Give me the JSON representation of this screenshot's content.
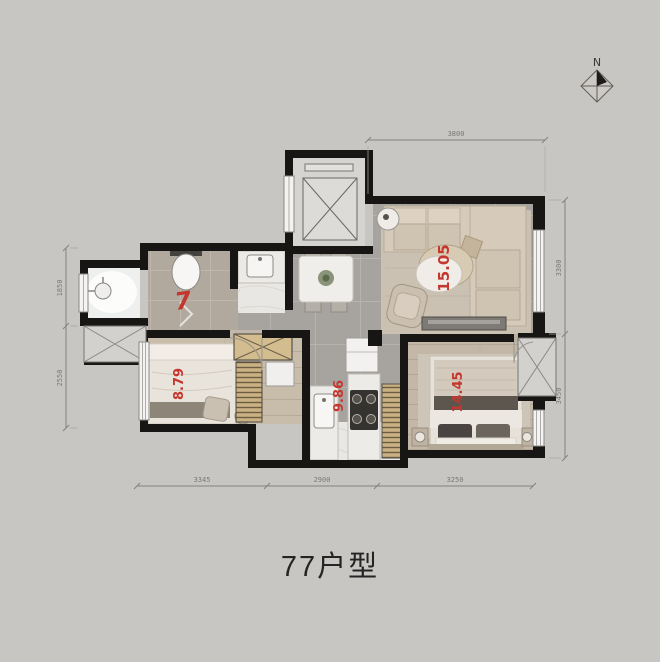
{
  "title": "77户型",
  "compass": {
    "label": "N"
  },
  "rooms": {
    "living": {
      "area": "15.05"
    },
    "bedroom2": {
      "area": "8.79"
    },
    "kitchen": {
      "area": "9.86"
    },
    "master": {
      "area": "14.45"
    }
  },
  "annotation": {
    "mark": "7"
  },
  "dimensions": {
    "top": "3800",
    "right_upper": "3300",
    "right_lower": "3450",
    "left_upper": "1850",
    "left_lower": "2550",
    "bottom_left": "3345",
    "bottom_middle": "2900",
    "bottom_right": "3250"
  },
  "colors": {
    "area_label": "#c4362e",
    "wall": "#171614",
    "background": "#c8c6c3"
  }
}
